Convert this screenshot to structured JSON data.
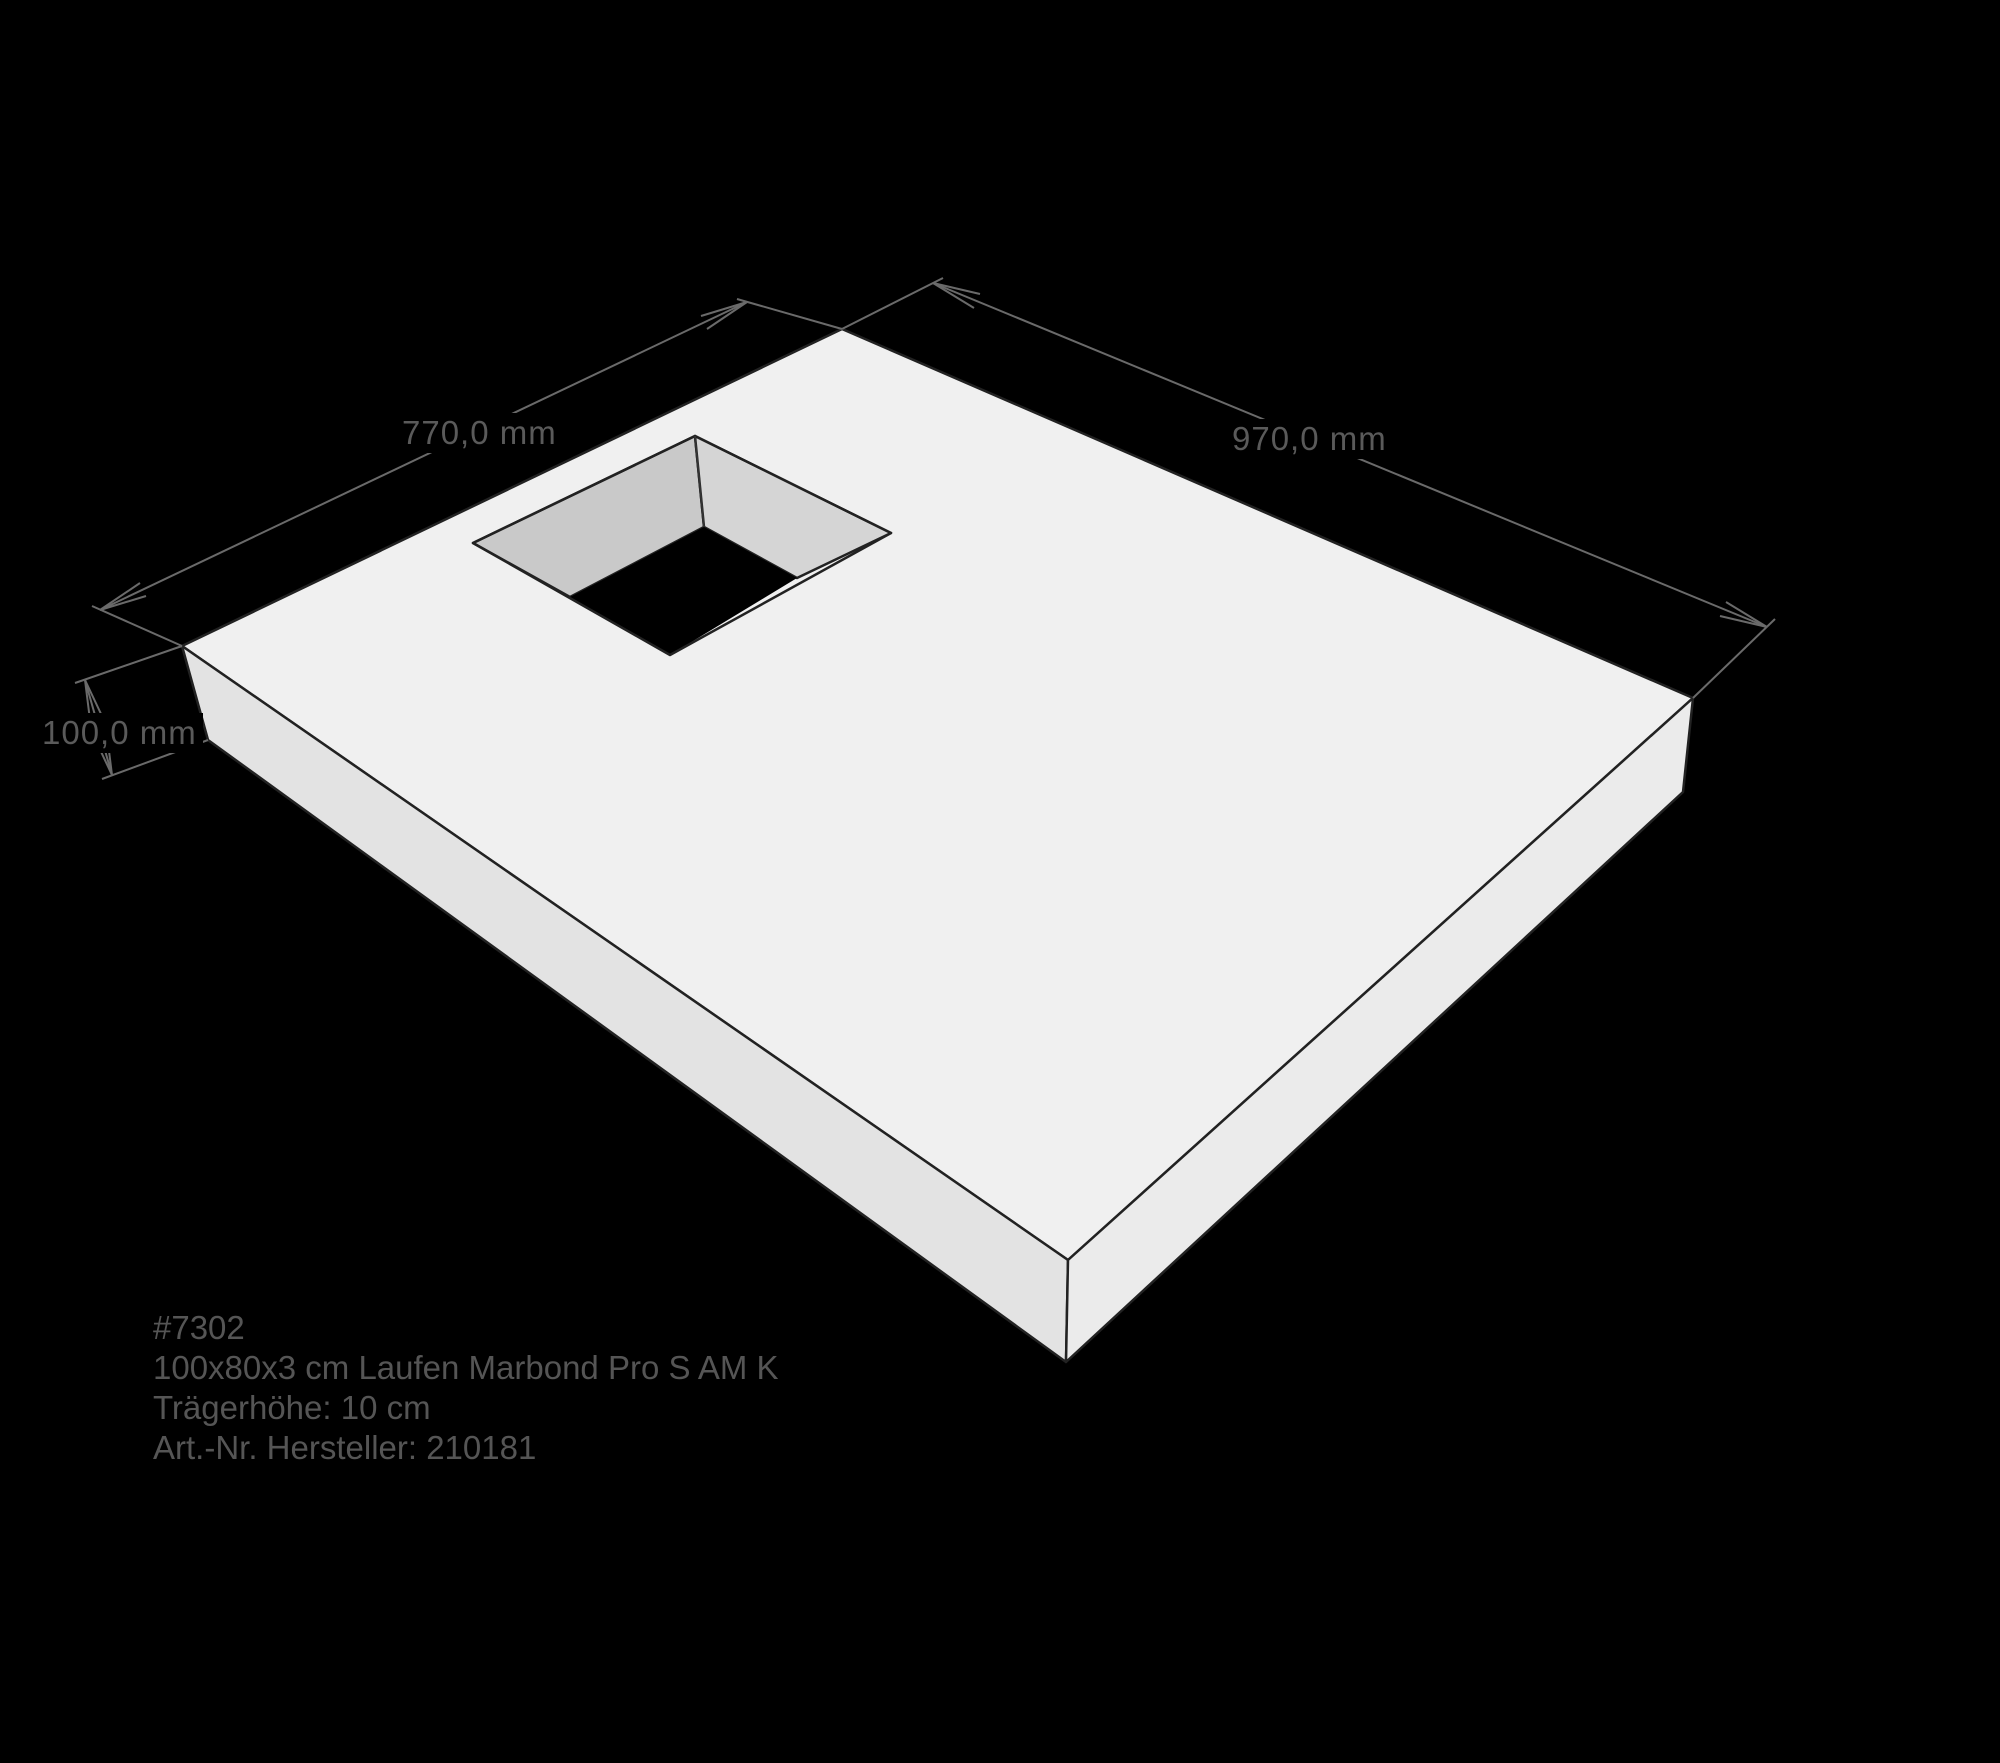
{
  "drawing": {
    "dimensions": {
      "edge_left": "770,0 mm",
      "edge_right": "970,0 mm",
      "height": "100,0 mm"
    },
    "annotation": {
      "line1": "#7302",
      "line2": "100x80x3 cm Laufen Marbond Pro S AM K",
      "line3": "Trägerhöhe: 10 cm",
      "line4": "Art.-Nr. Hersteller: 210181"
    },
    "colors": {
      "background": "#000000",
      "top_face": "#f0f0f0",
      "left_face": "#e3e3e3",
      "right_face": "#ebebeb",
      "hole_wall_left": "#c9c9c9",
      "hole_wall_right": "#d5d5d5",
      "outline": "#222222",
      "dimension_line": "#6a6a6a",
      "label_text": "#5a5a5a",
      "annotation_text": "#555555"
    }
  }
}
